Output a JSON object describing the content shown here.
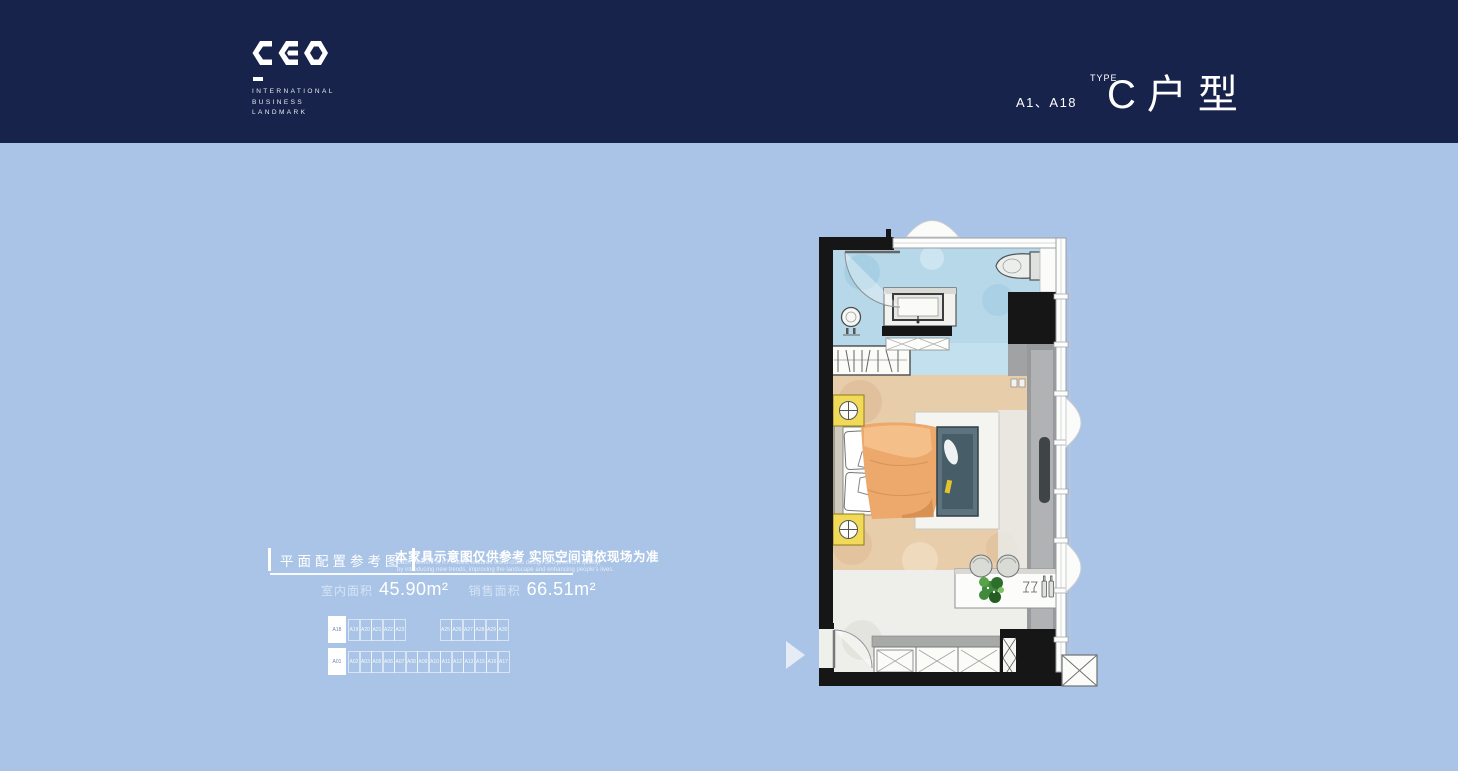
{
  "colors": {
    "header_bg": "#18234c",
    "body_bg": "#a9c4e6",
    "text": "#ffffff",
    "keyplan_highlight_bg": "#ffffff",
    "keyplan_highlight_text": "#6b87b5",
    "plan_bath_blue": "#b7d8e9",
    "plan_floor_tan": "#e8cdab",
    "plan_accent_yellow": "#f0da58",
    "plan_bed_orange": "#eda86b",
    "plan_sofa_teal": "#5d7480",
    "plan_plant_green": "#3f8a3c"
  },
  "header": {
    "logo_text": "CEO",
    "logo_lines": [
      "INTERNATIONAL",
      "BUSINESS",
      "LANDMARK"
    ],
    "unit_codes": "A1、A18",
    "type_superscript": "TYPE",
    "type_title": "C户型"
  },
  "info": {
    "section_title": "平面配置参考图",
    "notice_cn": "本家具示意图仅供参考 实际空间请依现场为准",
    "notice_en_line1": "Each element of KT Pacific features world-class design and premium quality,",
    "notice_en_line2": "by introducing new trends, improving the landscape and enhancing people's lives.",
    "area_items": [
      {
        "label": "室内面积",
        "value": "45.90m²"
      },
      {
        "label": "销售面积",
        "value": "66.51m²"
      }
    ]
  },
  "keyplan": {
    "top_row": [
      "A18",
      "A19",
      "A20",
      "A21",
      "A22",
      "A23",
      "",
      "A25",
      "A26",
      "A27",
      "A28",
      "A29",
      "A30"
    ],
    "bottom_row": [
      "A01",
      "A02",
      "A03",
      "A05",
      "A06",
      "A07",
      "A08",
      "A09",
      "A10",
      "A11",
      "A12",
      "A13",
      "A15",
      "A16",
      "A17"
    ],
    "highlighted": [
      "A18",
      "A01"
    ]
  }
}
